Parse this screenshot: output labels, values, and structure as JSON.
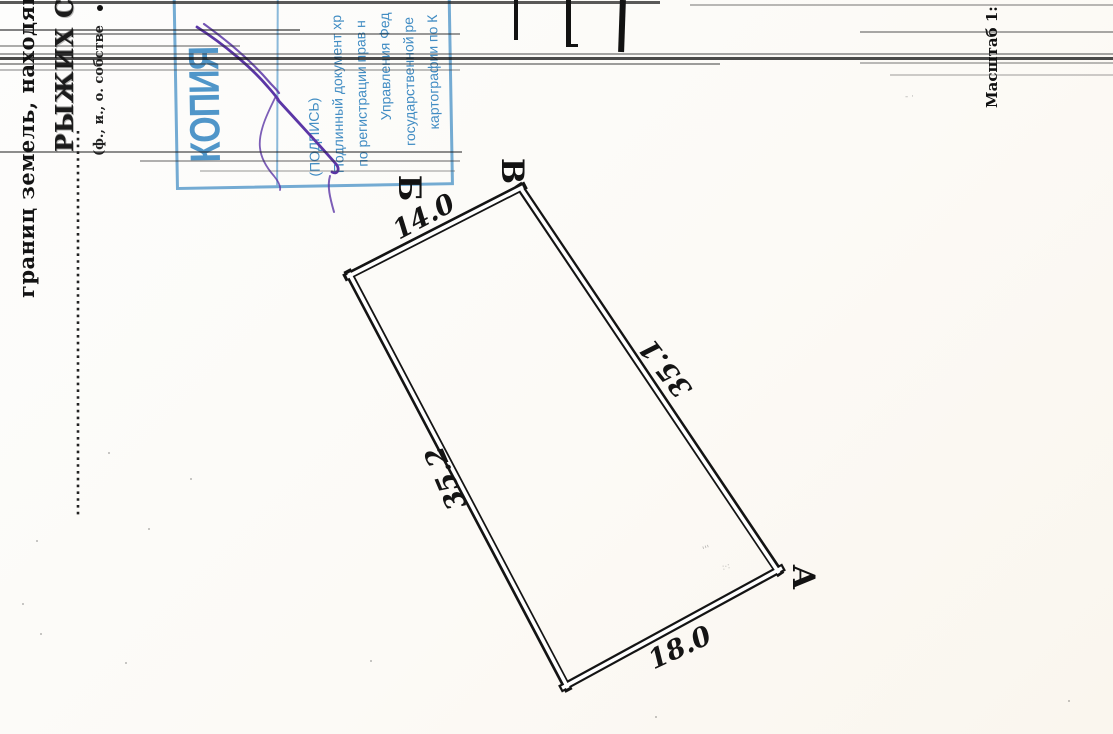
{
  "margin": {
    "boundary_text": "границ земель, находящи",
    "owner_name": "РЫЖИХ С.А",
    "owner_caption": "(ф., и., о. собстве",
    "scale_label": "Масштаб 1:"
  },
  "stamp": {
    "title": "КОПИЯ",
    "lines": [
      "(ПОДПИСЬ)",
      "Подлинный документ хр",
      "по регистрации прав н",
      "Управления Фед",
      "государственной ре",
      "картографии по К"
    ],
    "ink_color": "#3f8fc4"
  },
  "signature": {
    "ink_color": "#5b36a6"
  },
  "plot": {
    "corner_labels": {
      "b": "Б",
      "v": "В",
      "a": "А"
    },
    "dimensions": {
      "top": "14.0",
      "right": "35.1",
      "left": "35.2",
      "bottom": "18.0"
    },
    "line_color": "#141414"
  }
}
